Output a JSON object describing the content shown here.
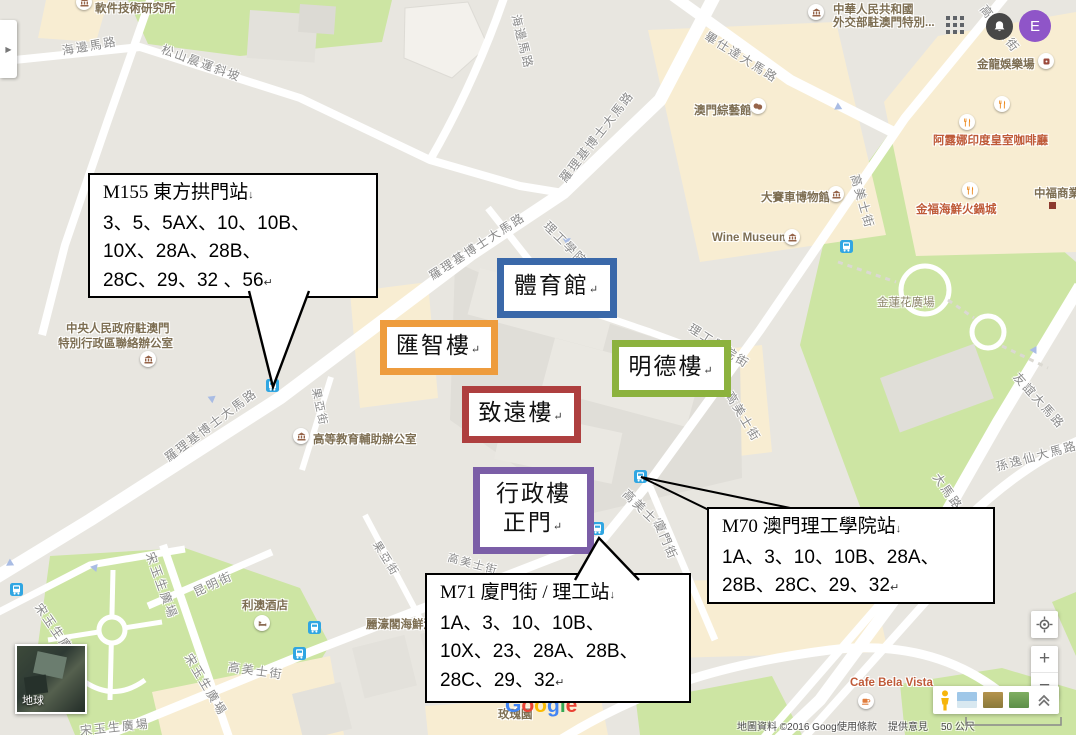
{
  "ui": {
    "avatar_letter": "E",
    "panel_toggle_arrow": "▶",
    "zoom_in": "+",
    "zoom_out": "−",
    "scale_label": "50 公尺",
    "earth_label": "地球"
  },
  "attribution": {
    "copyright": "地圖資料 ©2016 Google",
    "terms": "使用條款",
    "feedback": "提供意見"
  },
  "logo": {
    "letters": [
      {
        "ch": "G",
        "color": "#4285F4"
      },
      {
        "ch": "o",
        "color": "#EA4335"
      },
      {
        "ch": "o",
        "color": "#FBBC05"
      },
      {
        "ch": "g",
        "color": "#4285F4"
      },
      {
        "ch": "l",
        "color": "#34A853"
      },
      {
        "ch": "e",
        "color": "#EA4335"
      }
    ]
  },
  "callouts": [
    {
      "id": "M155",
      "title": "M155 東方拱門站",
      "title_mark": "↓",
      "lines": [
        "3、5、5AX、10、10B、",
        "10X、28A、28B、",
        "28C、29、32 、56"
      ],
      "end_mark": "↵"
    },
    {
      "id": "M70",
      "title": "M70 澳門理工學院站",
      "title_mark": "↓",
      "lines": [
        "1A、3、10、10B、28A、",
        "28B、28C、29、32"
      ],
      "end_mark": "↵"
    },
    {
      "id": "M71",
      "title": "M71 廈門街 / 理工站",
      "title_mark": "↓",
      "lines": [
        "1A、3、10、10B、",
        "10X、23、28A、28B、",
        "28C、29、32"
      ],
      "end_mark": "↵"
    }
  ],
  "campus_labels": [
    {
      "text": "體育館",
      "mark": "↵",
      "color": "#3a68a9"
    },
    {
      "text": "匯智樓",
      "mark": "↵",
      "color": "#ee9c3d"
    },
    {
      "text": "明德樓",
      "mark": "↵",
      "color": "#8cb23e"
    },
    {
      "text": "致遠樓",
      "mark": "↵",
      "color": "#ae3f3f"
    },
    {
      "text": "行政樓",
      "text2": "正門",
      "mark": "↵",
      "color": "#7b5ea7"
    }
  ],
  "streets": [
    {
      "text": "海邊馬路"
    },
    {
      "text": "松山晨運斜坡"
    },
    {
      "text": "海邊馬路"
    },
    {
      "text": "畢仕達大馬路"
    },
    {
      "text": "羅理基博士大馬路"
    },
    {
      "text": "羅理基博士大馬路"
    },
    {
      "text": "羅理基博士大馬路"
    },
    {
      "text": "理工學院街"
    },
    {
      "text": "理工學院街"
    },
    {
      "text": "高美士街"
    },
    {
      "text": "高美士街"
    },
    {
      "text": "高美士街"
    },
    {
      "text": "高美士街"
    },
    {
      "text": "高美士街"
    },
    {
      "text": "高美士街"
    },
    {
      "text": "廈門街"
    },
    {
      "text": "果亞街"
    },
    {
      "text": "果亞街"
    },
    {
      "text": "昆明街"
    },
    {
      "text": "宋玉生廣場"
    },
    {
      "text": "宋玉生廣場"
    },
    {
      "text": "宋玉生廣場"
    },
    {
      "text": "友誼大馬路"
    },
    {
      "text": "孫逸仙大馬路"
    },
    {
      "text": "大馬路"
    },
    {
      "text": "宋玉生廣場"
    }
  ],
  "pois": [
    {
      "text": "軟件技術研究所"
    },
    {
      "line1": "中華人民共和國",
      "line2": "外交部駐澳門特別..."
    },
    {
      "text": "金龍娛樂場"
    },
    {
      "text": "阿露娜印度皇室咖啡廳"
    },
    {
      "text": "金福海鮮火鍋城"
    },
    {
      "text": "中福商業"
    },
    {
      "text": "澳門綜藝館"
    },
    {
      "text": "大賽車博物館"
    },
    {
      "text": "Wine Museum"
    },
    {
      "text": "金蓮花廣場"
    },
    {
      "line1": "中央人民政府駐澳門",
      "line2": "特別行政區聯絡辦公室"
    },
    {
      "text": "高等教育輔助辦公室"
    },
    {
      "text": "利澳酒店"
    },
    {
      "text": "麗濠閣海鮮酒家"
    },
    {
      "text": "Cafe Bela Vista"
    },
    {
      "text": "玫瑰園"
    }
  ],
  "colors": {
    "land": "#e8e6e0",
    "park": "#cde5a3",
    "beige": "#f8edd2",
    "road": "#ffffff",
    "bus_icon": "#30a6e2",
    "avatar": "#8f55c8"
  }
}
